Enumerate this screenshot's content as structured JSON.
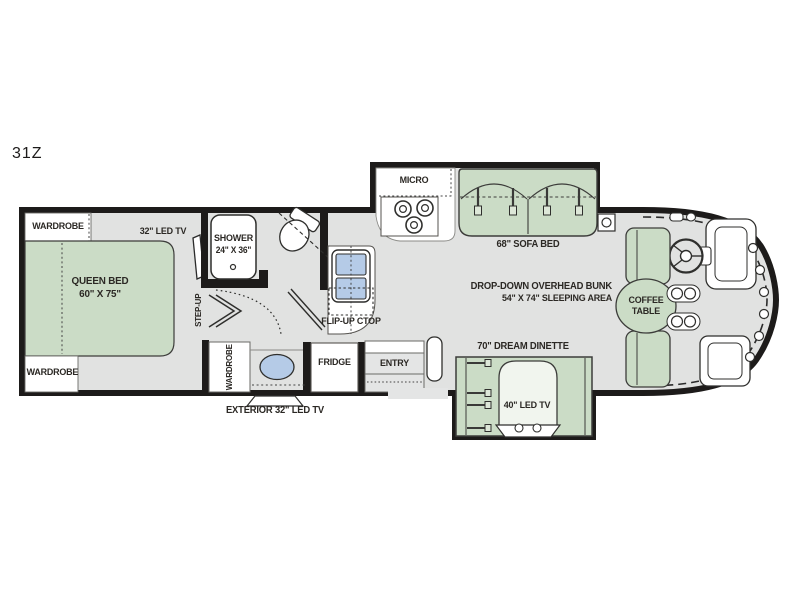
{
  "plan": {
    "model": "31Z"
  },
  "colors": {
    "wall": "#1d1b1a",
    "floor": "#e1e2e1",
    "furniture_green": "#cbdcc6",
    "sink_blue": "#b5cbe7",
    "white": "#ffffff",
    "text": "#2b2824"
  },
  "labels": {
    "wardrobe_front": "WARDROBE",
    "wardrobe_rear": "WARDROBE",
    "wardrobe_mid": "WARDROBE",
    "queen_bed_line1": "QUEEN BED",
    "queen_bed_line2": "60\" X 75\"",
    "bedroom_tv": "32\" LED TV",
    "step_up": "STEP-UP",
    "shower_line1": "SHOWER",
    "shower_line2": "24\" X 36\"",
    "micro": "MICRO",
    "flip_up_ctop": "FLIP-UP CTOP",
    "sofa_bed": "68\" SOFA BED",
    "bunk_line1": "DROP-DOWN OVERHEAD BUNK",
    "bunk_line2": "54\" X 74\" SLEEPING AREA",
    "coffee_table_line1": "COFFEE",
    "coffee_table_line2": "TABLE",
    "dinette": "70\" DREAM DINETTE",
    "dinette_tv": "40\" LED TV",
    "fridge": "FRIDGE",
    "entry": "ENTRY",
    "exterior_tv": "EXTERIOR 32\" LED TV"
  }
}
